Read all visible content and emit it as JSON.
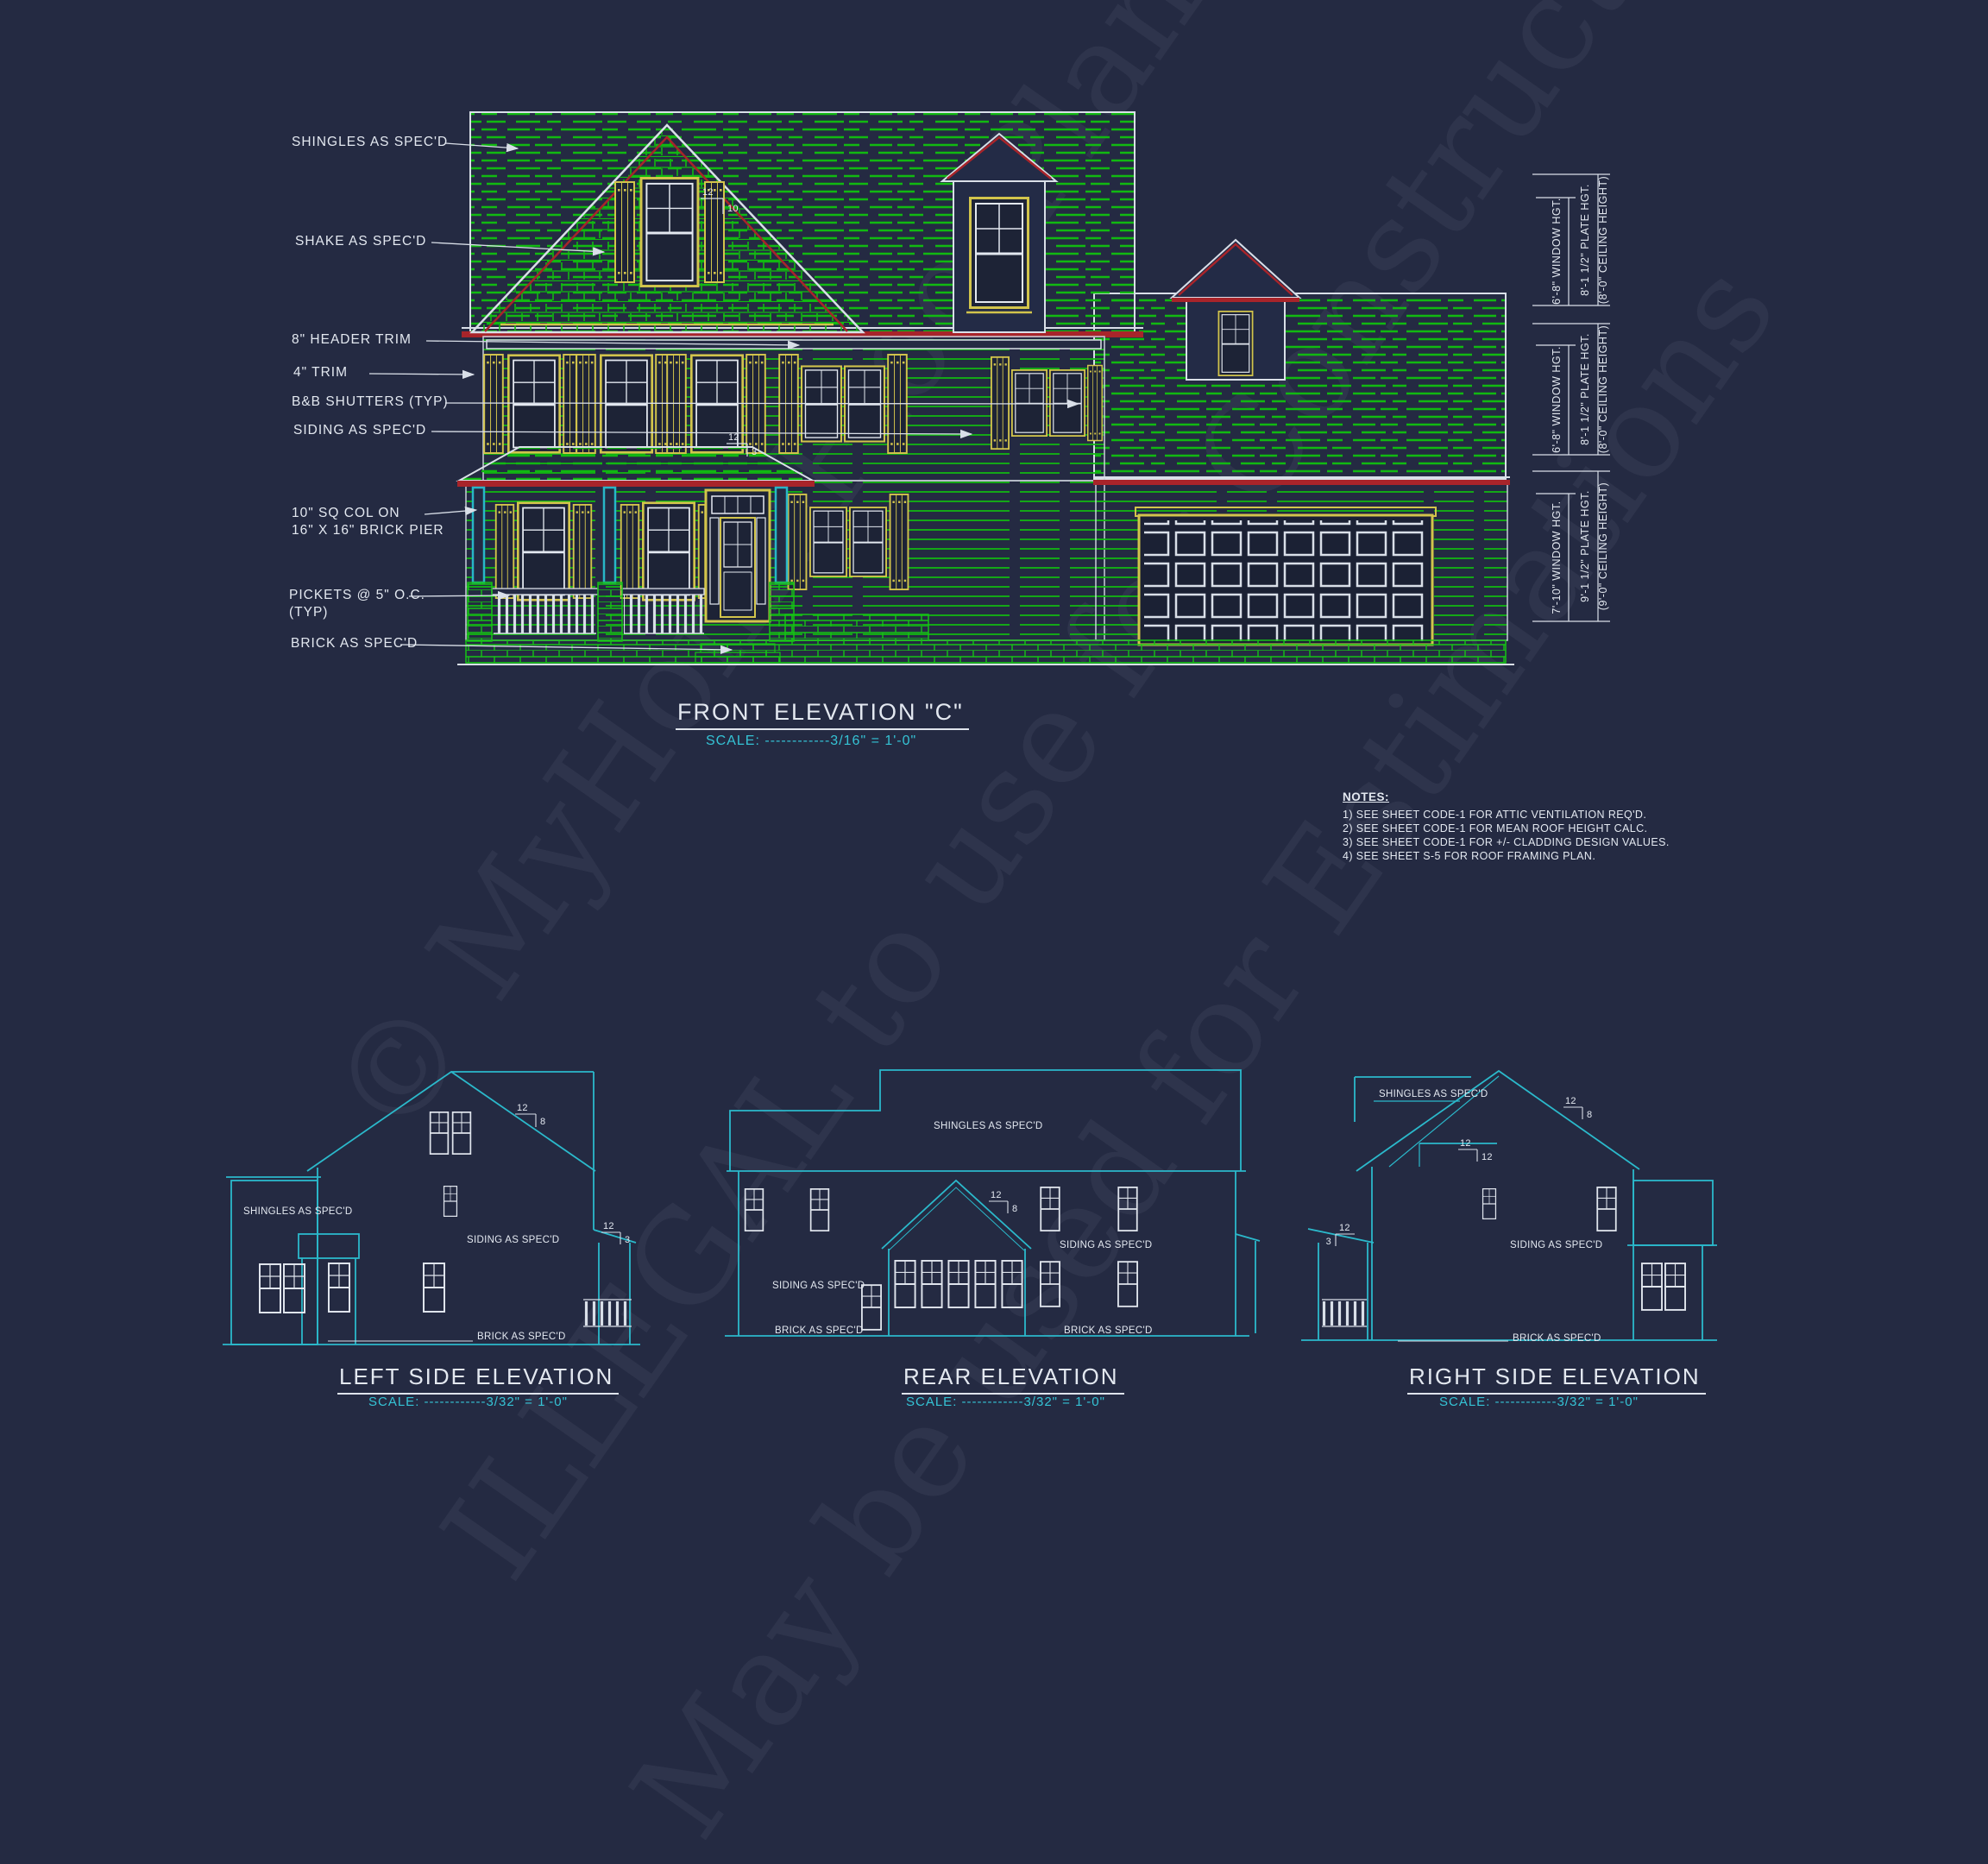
{
  "watermark": {
    "line1": "© MyHomeFloorPlans",
    "line2": "ILLEGAL to use for Construction",
    "line3": "May be used for Estimations"
  },
  "front": {
    "title": "FRONT ELEVATION \"C\"",
    "scale": "SCALE: ------------3/16\" = 1'-0\"",
    "callouts": {
      "shingles": "SHINGLES AS SPEC'D",
      "shake": "SHAKE AS SPEC'D",
      "header_trim": "8\" HEADER TRIM",
      "trim": "4\" TRIM",
      "shutters": "B&B SHUTTERS (TYP)",
      "siding": "SIDING AS SPEC'D",
      "col_line1": "10\" SQ COL ON",
      "col_line2": "16\" X 16\" BRICK PIER",
      "pickets_line1": "PICKETS @ 5\" O.C.",
      "pickets_line2": "(TYP)",
      "brick": "BRICK AS SPEC'D"
    },
    "pitch_main": {
      "run": "12",
      "rise": "10"
    },
    "pitch_porch": {
      "run": "12",
      "rise": "3"
    }
  },
  "dimensions": {
    "upper": {
      "window": "6'-8\" WINDOW HGT.",
      "plate": "8'-1 1/2\" PLATE HGT.",
      "ceiling": "(8'-0\" CEILING HEIGHT)"
    },
    "middle": {
      "window": "6'-8\" WINDOW HGT.",
      "plate": "8'-1 1/2\" PLATE HGT.",
      "ceiling": "(8'-0\" CEILING HEIGHT)"
    },
    "lower": {
      "window": "7'-10\" WINDOW HGT.",
      "plate": "9'-1 1/2\" PLATE HGT.",
      "ceiling": "(9'-0\" CEILING HEIGHT)"
    }
  },
  "notes": {
    "heading": "NOTES:",
    "items": [
      "1)  SEE SHEET CODE-1 FOR ATTIC VENTILATION REQ'D.",
      "2)  SEE SHEET CODE-1 FOR MEAN ROOF HEIGHT CALC.",
      "3)  SEE SHEET CODE-1 FOR +/- CLADDING DESIGN VALUES.",
      "4)  SEE SHEET S-5 FOR ROOF FRAMING PLAN."
    ]
  },
  "left_elevation": {
    "title": "LEFT SIDE ELEVATION",
    "scale": "SCALE: ------------3/32\" = 1'-0\"",
    "labels": {
      "shingles": "SHINGLES AS SPEC'D",
      "siding": "SIDING AS SPEC'D",
      "brick": "BRICK AS SPEC'D"
    },
    "pitch_main": {
      "run": "12",
      "rise": "8"
    },
    "pitch_porch": {
      "run": "12",
      "rise": "3"
    }
  },
  "rear_elevation": {
    "title": "REAR ELEVATION",
    "scale": "SCALE: ------------3/32\" = 1'-0\"",
    "labels": {
      "shingles": "SHINGLES AS SPEC'D",
      "siding_left": "SIDING AS SPEC'D",
      "siding_right": "SIDING AS SPEC'D",
      "brick_left": "BRICK AS SPEC'D",
      "brick_right": "BRICK AS SPEC'D"
    },
    "pitch": {
      "run": "12",
      "rise": "8"
    }
  },
  "right_elevation": {
    "title": "RIGHT SIDE ELEVATION",
    "scale": "SCALE: ------------3/32\" = 1'-0\"",
    "labels": {
      "shingles": "SHINGLES AS SPEC'D",
      "siding": "SIDING AS SPEC'D",
      "brick": "BRICK AS SPEC'D"
    },
    "pitch_main": {
      "run": "12",
      "rise": "8"
    },
    "pitch_upper": {
      "run": "12",
      "rise": "12"
    },
    "pitch_porch": {
      "run": "12",
      "rise": "3"
    }
  },
  "colors": {
    "background": "#242a42",
    "line_green": "#11b911",
    "brick_green": "#16c216",
    "trim_yellow": "#d2c44c",
    "trim_red": "#a8242a",
    "line_cyan": "#2bb9cb",
    "line_white": "#d9dfe8",
    "text_cyan": "#35c3d5"
  }
}
